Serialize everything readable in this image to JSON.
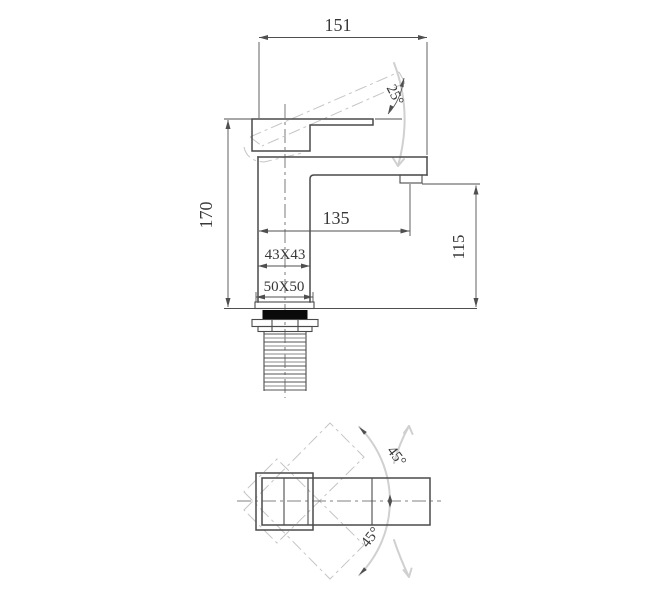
{
  "drawing": {
    "subject": "basin-faucet-engineering-drawing",
    "views": [
      "front-elevation",
      "plan-view"
    ],
    "colors": {
      "object_line": "#4a4a4a",
      "dimension_line": "#4f4f4f",
      "phantom_line": "#c5c5c5",
      "gasket_fill": "#0a0a0a",
      "background": "#ffffff"
    }
  },
  "front_view": {
    "dim_overall_width": "151",
    "dim_handle_angle": "25°",
    "dim_overall_height": "170",
    "dim_spout_reach": "135",
    "dim_outlet_height": "115",
    "dim_body_section": "43X43",
    "dim_base_section": "50X50"
  },
  "plan_view": {
    "dim_swing_upper": "45°",
    "dim_swing_lower": "45°"
  }
}
